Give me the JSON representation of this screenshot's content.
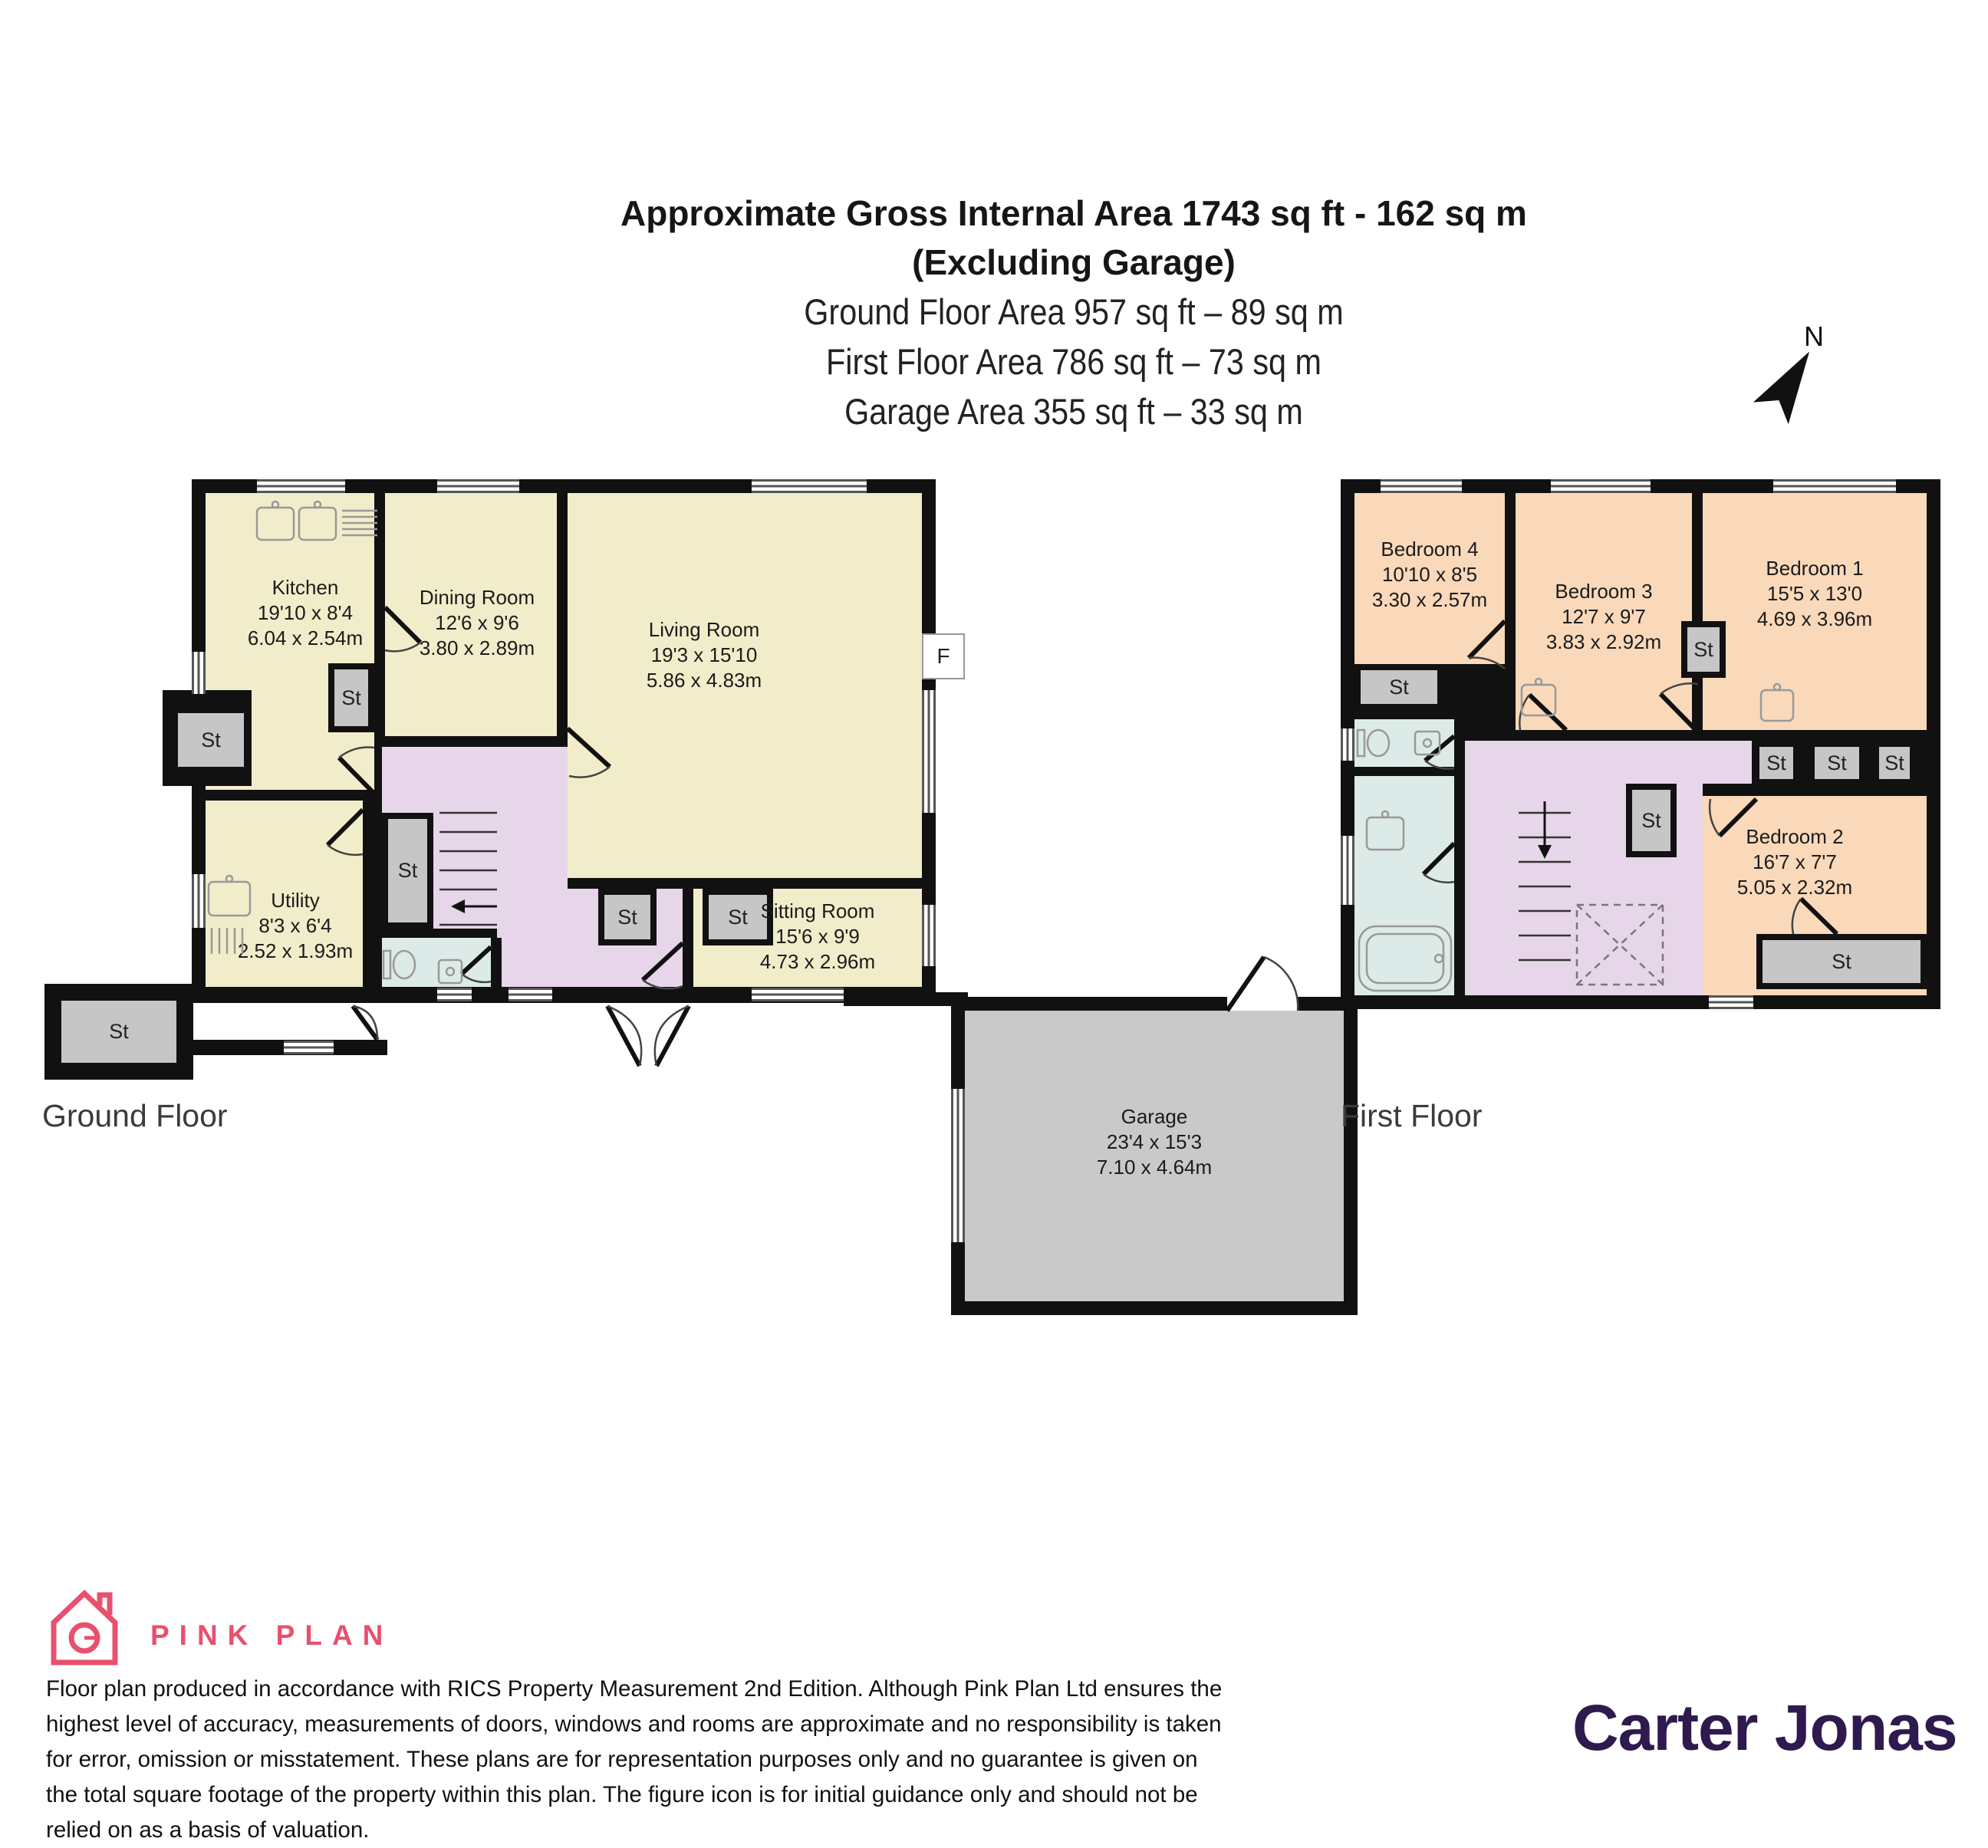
{
  "header": {
    "line1": "Approximate Gross Internal Area 1743 sq ft - 162 sq m",
    "line2": "(Excluding Garage)",
    "line3": "Ground Floor Area 957 sq ft – 89 sq m",
    "line4": "First Floor Area 786 sq ft – 73 sq m",
    "line5": "Garage Area 355 sq ft – 33 sq m"
  },
  "labels": {
    "north": "N",
    "storage": "St",
    "fireplace": "F"
  },
  "floors": {
    "ground": {
      "label": "Ground Floor",
      "rooms": [
        {
          "name": "Kitchen",
          "ft": "19'10 x 8'4",
          "m": "6.04 x 2.54m"
        },
        {
          "name": "Dining Room",
          "ft": "12'6 x 9'6",
          "m": "3.80 x 2.89m"
        },
        {
          "name": "Living Room",
          "ft": "19'3 x 15'10",
          "m": "5.86 x 4.83m"
        },
        {
          "name": "Sitting Room",
          "ft": "15'6 x 9'9",
          "m": "4.73 x 2.96m"
        },
        {
          "name": "Utility",
          "ft": "8'3 x 6'4",
          "m": "2.52 x 1.93m"
        },
        {
          "name": "Garage",
          "ft": "23'4 x 15'3",
          "m": "7.10 x 4.64m"
        }
      ]
    },
    "first": {
      "label": "First Floor",
      "rooms": [
        {
          "name": "Bedroom 4",
          "ft": "10'10 x 8'5",
          "m": "3.30 x 2.57m"
        },
        {
          "name": "Bedroom 3",
          "ft": "12'7 x 9'7",
          "m": "3.83 x 2.92m"
        },
        {
          "name": "Bedroom 1",
          "ft": "15'5 x 13'0",
          "m": "4.69 x 3.96m"
        },
        {
          "name": "Bedroom 2",
          "ft": "16'7 x 7'7",
          "m": "5.05 x 2.32m"
        }
      ]
    }
  },
  "footer": {
    "pink_plan": "PINK PLAN",
    "agent": "Carter Jonas",
    "disclaimer": "Floor plan produced in accordance with RICS Property Measurement 2nd Edition. Although Pink Plan Ltd ensures the highest level of accuracy, measurements of doors, windows and rooms are approximate and no responsibility is taken for error, omission or misstatement. These plans are for representation purposes only and no guarantee is given on the total square footage of the property within this plan. The figure icon is for initial guidance only and should not be relied on as a basis of valuation."
  },
  "colors": {
    "cream": "#f1edca",
    "peach": "#f9d9ba",
    "lavender": "#e7d6e9",
    "teal": "#dcebe7",
    "storage_gray": "#c6c6c6",
    "garage_gray": "#c9c9c9",
    "wall": "#111111",
    "pink": "#e8506e",
    "purple": "#2e1a4e"
  }
}
